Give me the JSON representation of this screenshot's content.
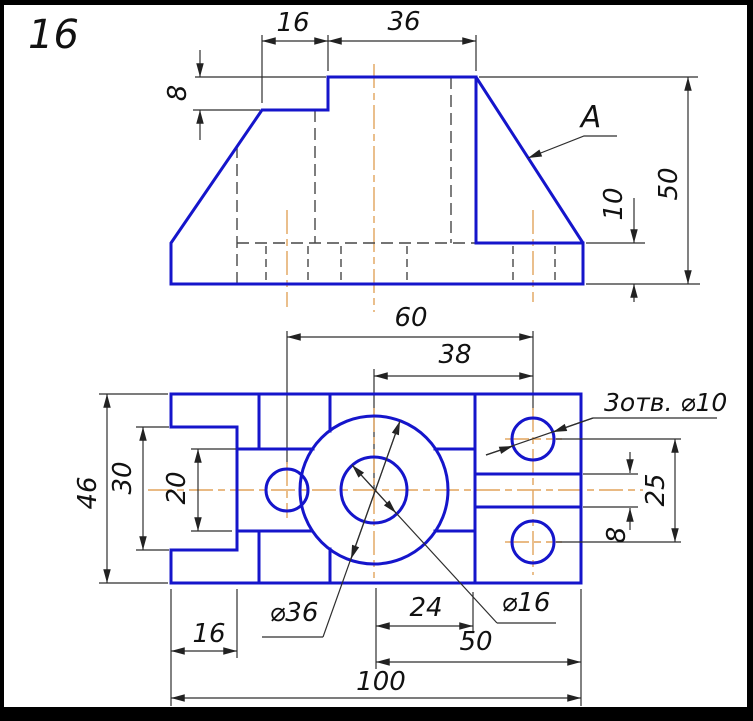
{
  "page": {
    "sheet_number": "16"
  },
  "colors": {
    "part_line": "#1515cb",
    "thin_line": "#2e2e2e",
    "hidden_line": "#474747",
    "center_line": "#e2a45c",
    "text_color": "#111111",
    "canvas": "#ffffff",
    "frame": "#000000"
  },
  "views": {
    "front_view": {
      "face_label": "A",
      "dims": {
        "step_offset": "16",
        "top_width": "36",
        "step_height": "8",
        "total_height": "50",
        "flange_height": "10"
      }
    },
    "plan_view": {
      "dims": {
        "holes_span": "60",
        "boss_to_holes": "38",
        "total_depth": "46",
        "notch_depth": "30",
        "slot_width": "20",
        "tab_width": "16",
        "boss_diameter": "⌀36",
        "center_hole_diameter": "⌀16",
        "holes_note": "3отв. ⌀10",
        "boss_to_divider": "24",
        "boss_to_edge": "50",
        "total_width": "100",
        "right_holes_spacing": "25",
        "groove_width": "8"
      }
    }
  }
}
